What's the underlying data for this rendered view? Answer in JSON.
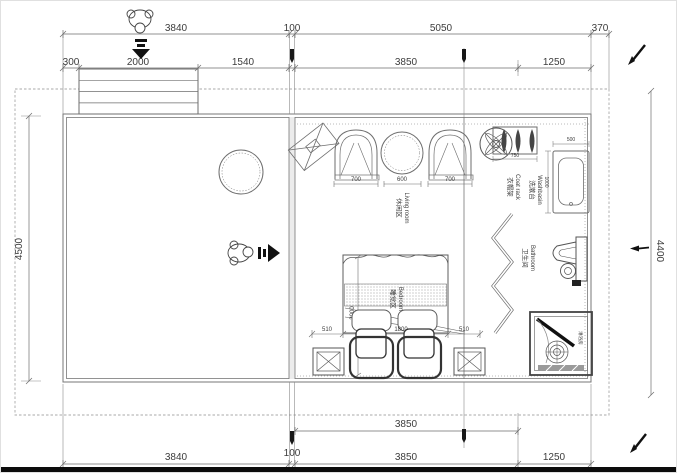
{
  "drawing": {
    "dims": {
      "top1_3840": "3840",
      "top1_100": "100",
      "top1_5050": "5050",
      "top1_370": "370",
      "top2_300": "300",
      "top2_2000": "2000",
      "top2_1540": "1540",
      "top2_3850": "3850",
      "top2_1250": "1250",
      "left_4500": "4500",
      "right_4400": "4400",
      "bottom1_3850": "3850",
      "bottom2_3840": "3840",
      "bottom2_100": "100",
      "bottom2_3850": "3850",
      "bottom2_1250": "1250",
      "chair_left": "700",
      "table": "600",
      "chair_right": "700",
      "rack_width": "750",
      "basin_width": "500",
      "basin_depth": "1000",
      "bed_left": "510",
      "bed_width": "1800",
      "bed_right": "510",
      "bed_length": "2000"
    },
    "labels": {
      "living_zh": "休闲区",
      "living_en": "Living room",
      "bedroom_zh": "睡觉区",
      "bedroom_en": "Bedroom",
      "rack_zh": "衣帽架",
      "rack_en": "Coat rack",
      "basin_zh": "洗漱台",
      "basin_en": "Washbasin",
      "bath_zh": "卫生间",
      "bath_en": "Bathroom",
      "shower_zh": "淋浴房"
    },
    "colors": {
      "wall": "#777777",
      "thin": "#8a8a8a",
      "dark": "#1a1a1a",
      "text": "#3c3c3c",
      "boundary_dash": "#a8a8a8"
    }
  }
}
